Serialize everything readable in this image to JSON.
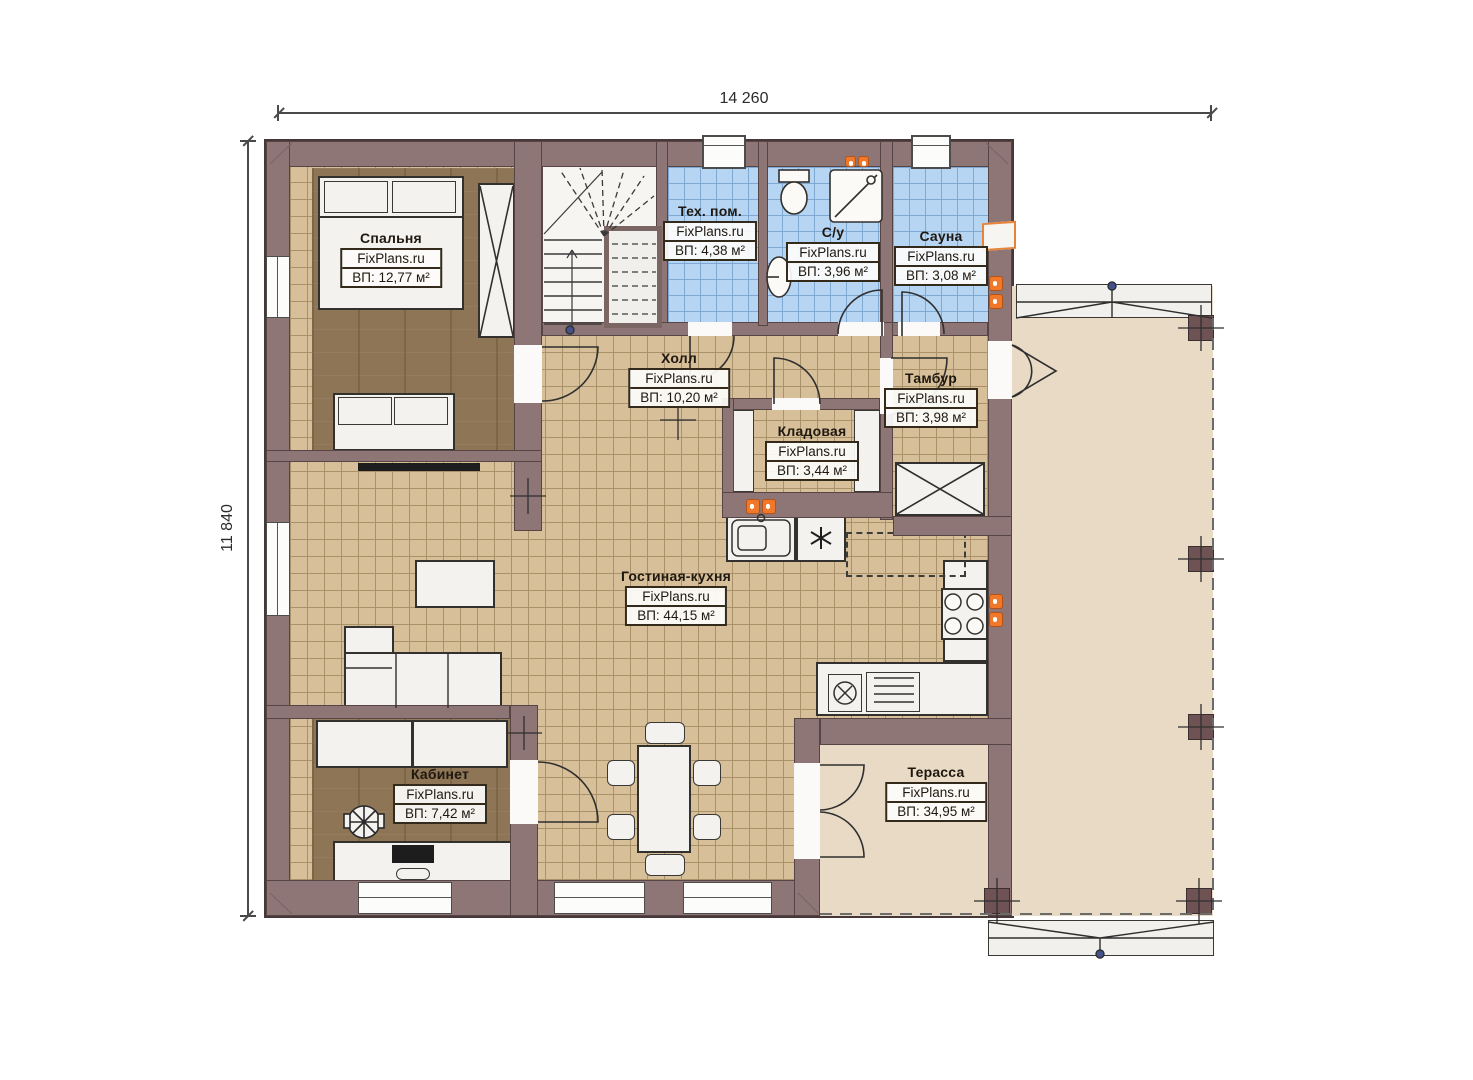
{
  "meta": {
    "watermark": "FixPlans.ru"
  },
  "dimensions": {
    "width_label": "14 260",
    "height_label": "11 840"
  },
  "rooms": [
    {
      "name": "Спальня",
      "area": "ВП: 12,77 м²"
    },
    {
      "name": "Тех. пом.",
      "area": "ВП: 4,38 м²"
    },
    {
      "name": "С/у",
      "area": "ВП: 3,96 м²"
    },
    {
      "name": "Сауна",
      "area": "ВП: 3,08 м²"
    },
    {
      "name": "Холл",
      "area": "ВП: 10,20 м²"
    },
    {
      "name": "Тамбур",
      "area": "ВП: 3,98 м²"
    },
    {
      "name": "Кладовая",
      "area": "ВП: 3,44 м²"
    },
    {
      "name": "Гостиная-кухня",
      "area": "ВП: 44,15 м²"
    },
    {
      "name": "Кабинет",
      "area": "ВП: 7,42 м²"
    },
    {
      "name": "Терасса",
      "area": "ВП: 34,95 м²"
    }
  ],
  "colors": {
    "wall": "#8e7576",
    "wood_floor": "#8d7555",
    "tile_floor": "#d7c099",
    "wet_tile_floor": "#b5d5f3",
    "terrace_floor": "#e8dac4",
    "radiator_accent": "#f0782a"
  }
}
